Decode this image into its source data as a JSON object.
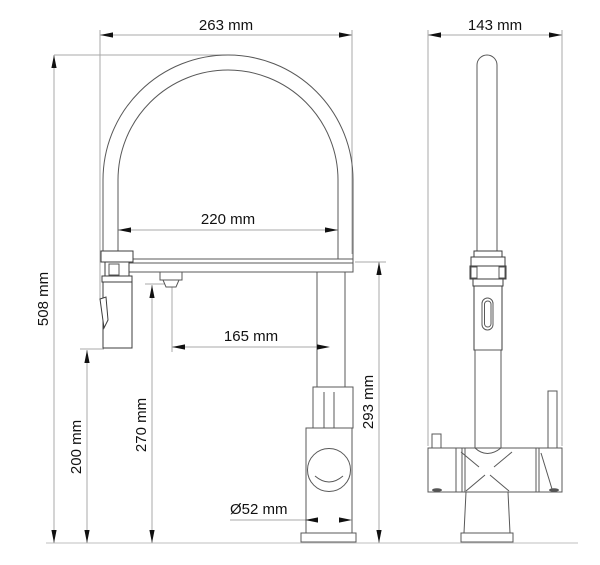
{
  "drawing": {
    "type": "technical-dimension-drawing",
    "subject": "kitchen-faucet-two-views",
    "unit": "mm"
  },
  "dimensions": {
    "d263": {
      "label": "263 mm",
      "value": 263
    },
    "d143": {
      "label": "143 mm",
      "value": 143
    },
    "d220": {
      "label": "220 mm",
      "value": 220
    },
    "d165": {
      "label": "165 mm",
      "value": 165
    },
    "d508": {
      "label": "508 mm",
      "value": 508
    },
    "d200": {
      "label": "200 mm",
      "value": 200
    },
    "d270": {
      "label": "270 mm",
      "value": 270
    },
    "d293": {
      "label": "293 mm",
      "value": 293
    },
    "d52": {
      "label": "Ø52 mm",
      "value": 52
    }
  },
  "colors": {
    "background": "#ffffff",
    "object_line": "#585858",
    "dimension_line": "#a8a8a8",
    "text": "#111111",
    "baseline": "#cccccc"
  }
}
